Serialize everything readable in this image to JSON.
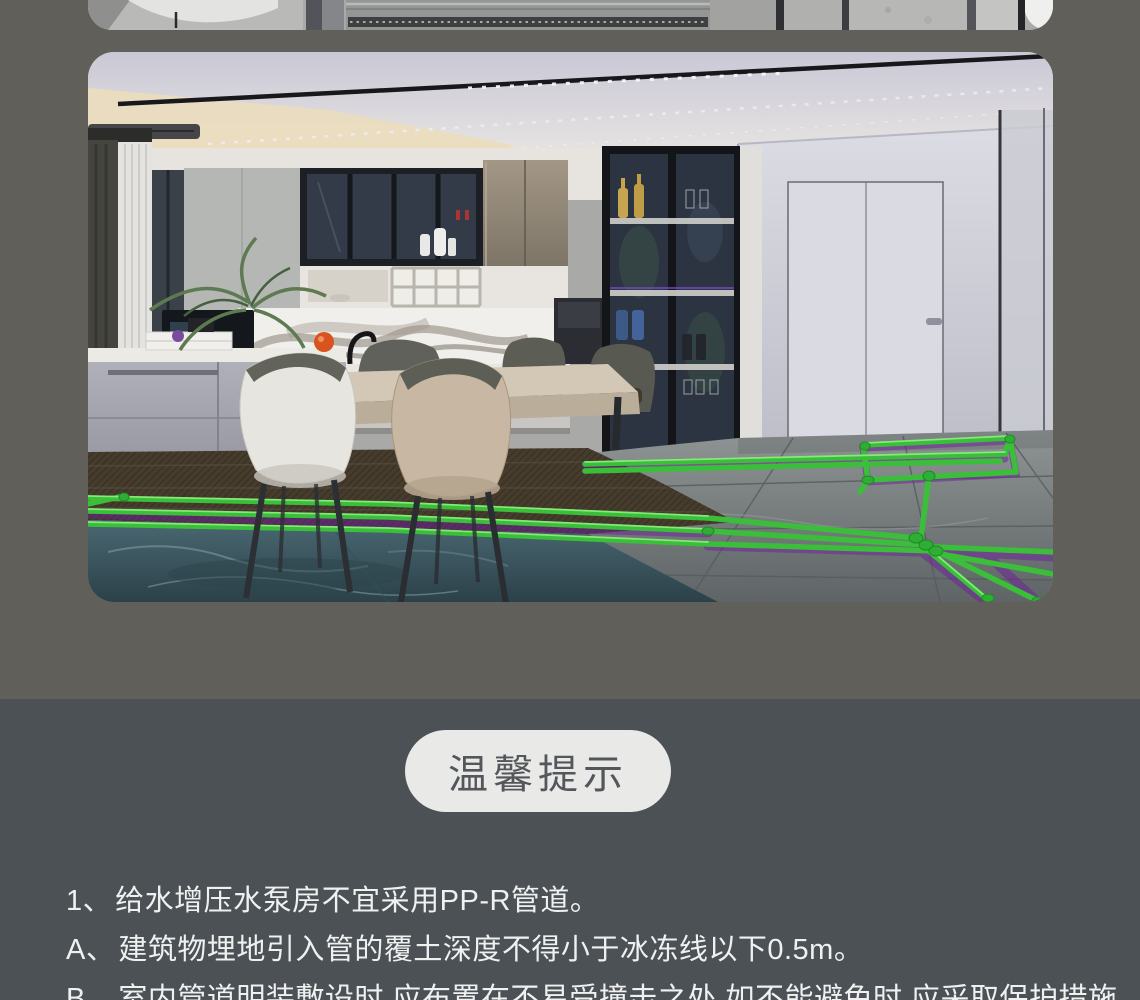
{
  "colors": {
    "page_bg_top": "#605f5a",
    "page_bg_bottom": "#4c5156",
    "badge_bg": "#e9e9e7",
    "badge_text": "#53565a",
    "tip_text": "#eff1f1",
    "pipe_green": "#3bbf3a",
    "pipe_glow_purple": "#6f1e9d"
  },
  "images": {
    "top_strip_alt": "管道安装工艺细节图(底部局部)",
    "kitchen_alt": "厨房地面PP-R给水管走管布置效果图(绿色管道)"
  },
  "tips": {
    "badge_label": "温馨提示",
    "items": [
      {
        "label": "1、",
        "text": "给水增压水泵房不宜采用PP-R管道。"
      },
      {
        "label": "A、",
        "text": "建筑物埋地引入管的覆土深度不得小于冰冻线以下0.5m。"
      },
      {
        "label": "B、",
        "text": "室内管道明装敷设时,应布置在不易受撞击之处,如不能避免时,应采取保护措施。"
      }
    ]
  }
}
